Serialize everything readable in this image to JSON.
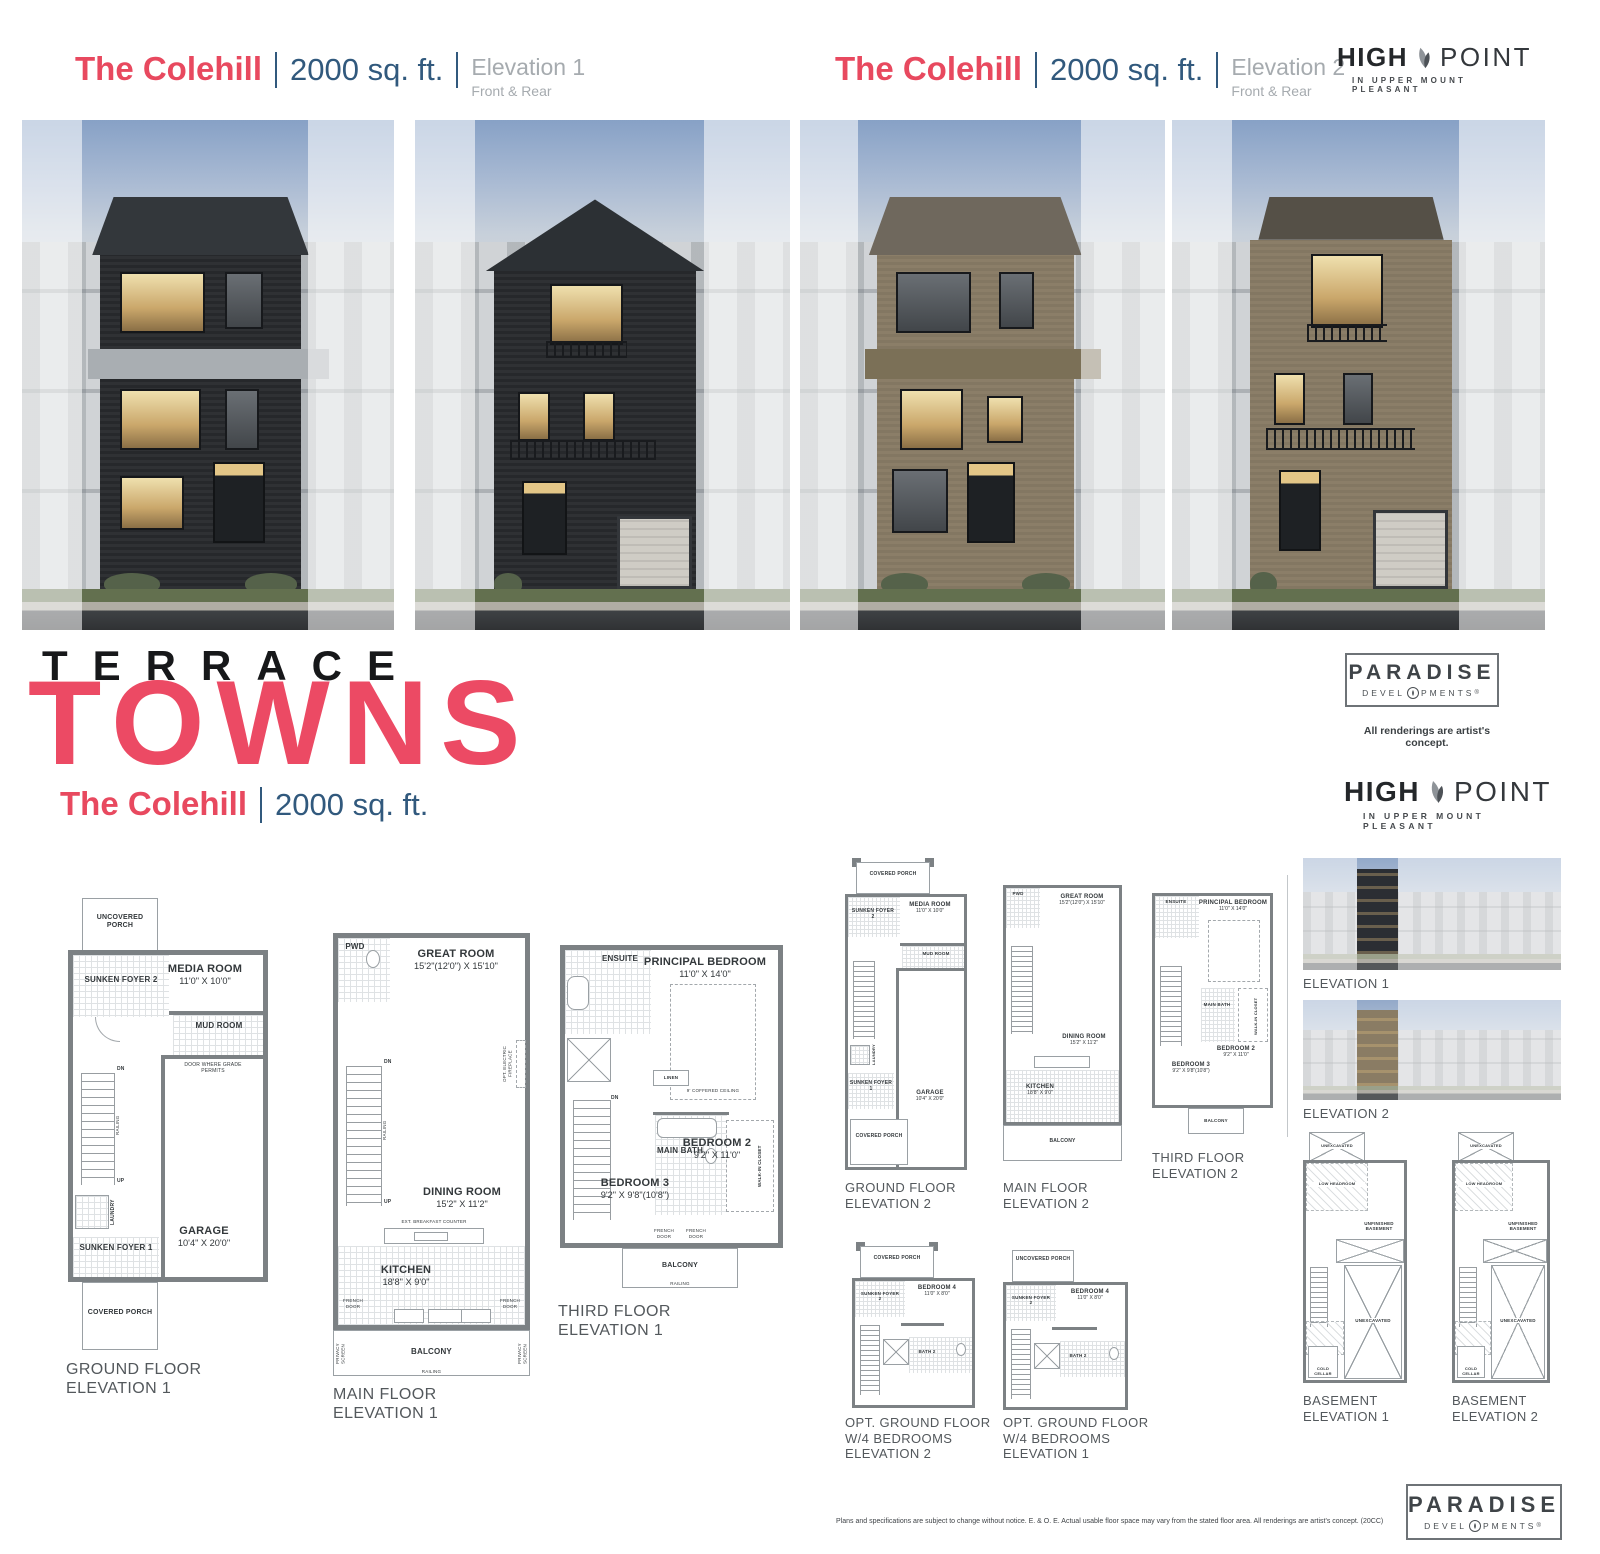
{
  "headers": [
    {
      "model": "The Colehill",
      "size": "2000 sq. ft.",
      "elevation": "Elevation 1",
      "view": "Front & Rear"
    },
    {
      "model": "The Colehill",
      "size": "2000 sq. ft.",
      "elevation": "Elevation 2",
      "view": "Front & Rear"
    }
  ],
  "hero": {
    "kicker": "TERRACE",
    "title": "TOWNS"
  },
  "subtitle": {
    "model": "The Colehill",
    "size": "2000 sq. ft."
  },
  "logos": {
    "highpoint": {
      "bold": "HIGH",
      "light": "POINT",
      "tagline": "IN UPPER MOUNT PLEASANT"
    },
    "paradise": {
      "name": "PARADISE",
      "dev_left": "DEVEL",
      "dev_right": "PMENTS",
      "reg": "®"
    },
    "artists_note": "All renderings are artist's concept."
  },
  "plans": {
    "gf_e1": {
      "cap1": "GROUND FLOOR",
      "cap2": "ELEVATION 1",
      "porch_top": "UNCOVERED PORCH",
      "foyer2": "SUNKEN FOYER 2",
      "media": "MEDIA ROOM",
      "media_d": "11'0\" x 10'0\"",
      "mud": "MUD ROOM",
      "door_note": "DOOR WHERE GRADE PERMITS",
      "laundry": "LAUNDRY",
      "foyer1": "SUNKEN FOYER 1",
      "garage": "GARAGE",
      "garage_d": "10'4\" x 20'0\"",
      "porch_bottom": "COVERED PORCH",
      "dn": "DN",
      "up": "UP",
      "railing": "RAILING"
    },
    "mf_e1": {
      "cap1": "MAIN FLOOR",
      "cap2": "ELEVATION 1",
      "pwd": "PWD",
      "great": "GREAT ROOM",
      "great_d": "15'2\"(12'0\") x 15'10\"",
      "fireplace": "OPT. ELECTRIC FIREPLACE",
      "dining": "DINING ROOM",
      "dining_d": "15'2\" x 11'2\"",
      "counter": "EXT. BREAKFAST COUNTER",
      "kitchen": "KITCHEN",
      "kitchen_d": "18'8\" x 9'0\"",
      "french": "FRENCH DOOR",
      "balcony": "BALCONY",
      "railing": "RAILING",
      "privacy": "PRIVACY SCREEN",
      "dn": "DN",
      "up": "UP"
    },
    "tf_e1": {
      "cap1": "THIRD FLOOR",
      "cap2": "ELEVATION 1",
      "ensuite": "ENSUITE",
      "principal": "PRINCIPAL BEDROOM",
      "principal_d": "11'0\" x 14'0\"",
      "coffered": "9' COFFERED CEILING",
      "linen": "LINEN",
      "bath": "MAIN BATH",
      "wic": "WALK-IN CLOSET",
      "bed3": "BEDROOM 3",
      "bed3_d": "9'2\" x 9'8\"(10'8\")",
      "bed2": "BEDROOM 2",
      "bed2_d": "9'2\" x 11'0\"",
      "french": "FRENCH DOOR",
      "balcony": "BALCONY",
      "railing": "RAILING",
      "dn": "DN"
    },
    "gf_e2": {
      "cap1": "GROUND FLOOR",
      "cap2": "ELEVATION 2",
      "porch_top": "COVERED PORCH",
      "foyer2": "SUNKEN FOYER 2",
      "media": "MEDIA ROOM",
      "media_d": "11'0\" x 10'0\"",
      "mud": "MUD ROOM",
      "laundry": "LAUNDRY",
      "foyer1": "SUNKEN FOYER 1",
      "garage": "GARAGE",
      "garage_d": "10'4\" x 20'0\"",
      "porch_bottom": "COVERED PORCH"
    },
    "mf_e2": {
      "cap1": "MAIN FLOOR",
      "cap2": "ELEVATION 2",
      "pwd": "PWD",
      "great": "GREAT ROOM",
      "great_d": "15'2\"(12'0\") x 15'10\"",
      "dining": "DINING ROOM",
      "dining_d": "15'2\" x 11'2\"",
      "kitchen": "KITCHEN",
      "kitchen_d": "18'8\" x 9'0\"",
      "balcony": "BALCONY"
    },
    "tf_e2": {
      "cap1": "THIRD FLOOR",
      "cap2": "ELEVATION 2",
      "ensuite": "ENSUITE",
      "principal": "PRINCIPAL BEDROOM",
      "principal_d": "11'0\" x 14'0\"",
      "bath": "MAIN BATH",
      "wic": "WALK-IN CLOSET",
      "bed2": "BEDROOM 2",
      "bed2_d": "9'2\" x 11'0\"",
      "bed3": "BEDROOM 3",
      "bed3_d": "9'2\" x 9'8\"(10'8\")",
      "balcony": "BALCONY"
    },
    "opt_e2": {
      "cap1": "OPT. GROUND FLOOR",
      "cap2": "W/4 BEDROOMS",
      "cap3": "ELEVATION 2",
      "porch": "COVERED PORCH",
      "foyer2": "SUNKEN FOYER 2",
      "bed4": "BEDROOM 4",
      "bed4_d": "11'0\" x 8'0\"",
      "bath2": "BATH 2"
    },
    "opt_e1": {
      "cap1": "OPT. GROUND FLOOR",
      "cap2": "W/4 BEDROOMS",
      "cap3": "ELEVATION 1",
      "porch": "UNCOVERED PORCH",
      "foyer2": "SUNKEN FOYER 2",
      "bed4": "BEDROOM 4",
      "bed4_d": "11'0\" x 8'0\"",
      "bath2": "BATH 2"
    },
    "bsmt_e1": {
      "cap1": "BASEMENT",
      "cap2": "ELEVATION 1",
      "unex_top": "UNEXCAVATED",
      "unfin1": "UNFINISHED",
      "unfin2": "BASEMENT",
      "unex": "UNEXCAVATED",
      "low": "LOW HEADROOM",
      "cold": "COLD CELLAR"
    },
    "bsmt_e2": {
      "cap1": "BASEMENT",
      "cap2": "ELEVATION 2",
      "unex_top": "UNEXCAVATED",
      "unfin1": "UNFINISHED",
      "unfin2": "BASEMENT",
      "unex": "UNEXCAVATED",
      "low": "LOW HEADROOM",
      "cold": "COLD CELLAR"
    }
  },
  "thumbs": {
    "e1": "ELEVATION 1",
    "e2": "ELEVATION 2"
  },
  "footer": {
    "disclaimer": "Plans and specifications are subject to change without notice. E. & O. E.  Actual usable floor space may vary from the stated floor area. All renderings are artist's concept. (20CC)"
  },
  "colors": {
    "pink": "#e8495f",
    "blue": "#31597d",
    "header_gray": "#a6abaf",
    "caption_gray": "#53585c",
    "wall_gray": "#7c8184"
  }
}
